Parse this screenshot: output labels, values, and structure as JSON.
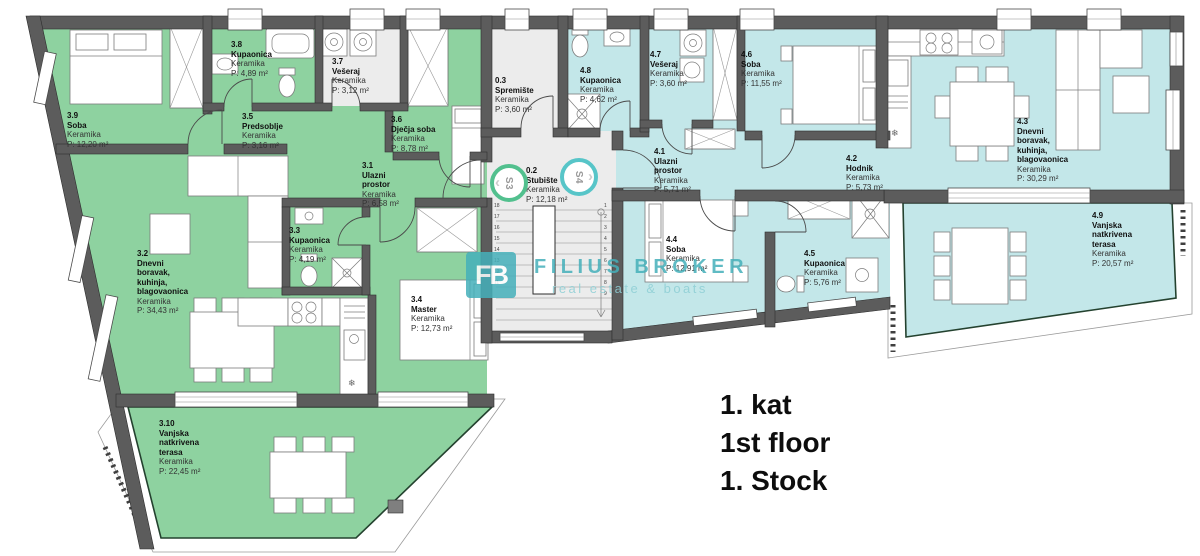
{
  "title_block": {
    "kat": "1. kat",
    "floor": "1st floor",
    "stock": "1. Stock"
  },
  "watermark": {
    "logo_text": "FB",
    "brand": "FILIUS BROKER",
    "tagline": "real estate & boats"
  },
  "stair_markers": [
    {
      "label": "S3"
    },
    {
      "label": "S4"
    }
  ],
  "stairs": {
    "left_step_numbers": [
      "18",
      "17",
      "16",
      "15",
      "14",
      "13",
      "12",
      "11"
    ],
    "right_step_numbers": [
      "1",
      "2",
      "3",
      "4",
      "5",
      "6",
      "7",
      "8",
      "9"
    ]
  },
  "colors": {
    "apartment3_fill": "#8ed2a0",
    "apartment4_fill": "#c3e7e9",
    "wall": "#5c5c5c",
    "utility_floor": "#ececec",
    "watermark_teal": "#45b0ba",
    "marker_s3_ring": "#52c08e",
    "marker_s4_ring": "#57c5c8"
  },
  "rooms": [
    {
      "id": "3.9",
      "name": "Soba",
      "material": "Keramika",
      "area": "P: 12,20 m²"
    },
    {
      "id": "3.8",
      "name": "Kupaonica",
      "material": "Keramika",
      "area": "P: 4,89 m²"
    },
    {
      "id": "3.7",
      "name": "Vešeraj",
      "material": "Keramika",
      "area": "P: 3,12 m²"
    },
    {
      "id": "3.5",
      "name": "Predsoblje",
      "material": "Keramika",
      "area": "P: 3,16 m²"
    },
    {
      "id": "3.6",
      "name": "Dječja soba",
      "material": "Keramika",
      "area": "P: 8,78 m²"
    },
    {
      "id": "3.1",
      "name": "Ulazni prostor",
      "material": "Keramika",
      "area": "P: 6,58 m²"
    },
    {
      "id": "3.3",
      "name": "Kupaonica",
      "material": "Keramika",
      "area": "P: 4,19 m²"
    },
    {
      "id": "3.2",
      "name": "Dnevni boravak, kuhinja, blagovaonica",
      "material": "Keramika",
      "area": "P: 34,43 m²"
    },
    {
      "id": "3.4",
      "name": "Master",
      "material": "Keramika",
      "area": "P: 12,73 m²"
    },
    {
      "id": "3.10",
      "name": "Vanjska natkrivena terasa",
      "material": "Keramika",
      "area": "P: 22,45 m²"
    },
    {
      "id": "0.3",
      "name": "Spremište",
      "material": "Keramika",
      "area": "P: 3,60 m²"
    },
    {
      "id": "0.2",
      "name": "Stubište",
      "material": "Keramika",
      "area": "P: 12,18 m²"
    },
    {
      "id": "4.8",
      "name": "Kupaonica",
      "material": "Keramika",
      "area": "P: 4,62 m²"
    },
    {
      "id": "4.7",
      "name": "Vešeraj",
      "material": "Keramika",
      "area": "P: 3,60 m²"
    },
    {
      "id": "4.6",
      "name": "Soba",
      "material": "Keramika",
      "area": "P: 11,55 m²"
    },
    {
      "id": "4.1",
      "name": "Ulazni prostor",
      "material": "Keramika",
      "area": "P: 5,71 m²"
    },
    {
      "id": "4.2",
      "name": "Hodnik",
      "material": "Keramika",
      "area": "P: 5,73 m²"
    },
    {
      "id": "4.3",
      "name": "Dnevni boravak, kuhinja, blagovaonica",
      "material": "Keramika",
      "area": "P: 30,29 m²"
    },
    {
      "id": "4.4",
      "name": "Soba",
      "material": "Keramika",
      "area": "P: 12,91 m²"
    },
    {
      "id": "4.5",
      "name": "Kupaonica",
      "material": "Keramika",
      "area": "P: 5,76 m²"
    },
    {
      "id": "4.9",
      "name": "Vanjska natkrivena terasa",
      "material": "Keramika",
      "area": "P: 20,57 m²"
    }
  ]
}
